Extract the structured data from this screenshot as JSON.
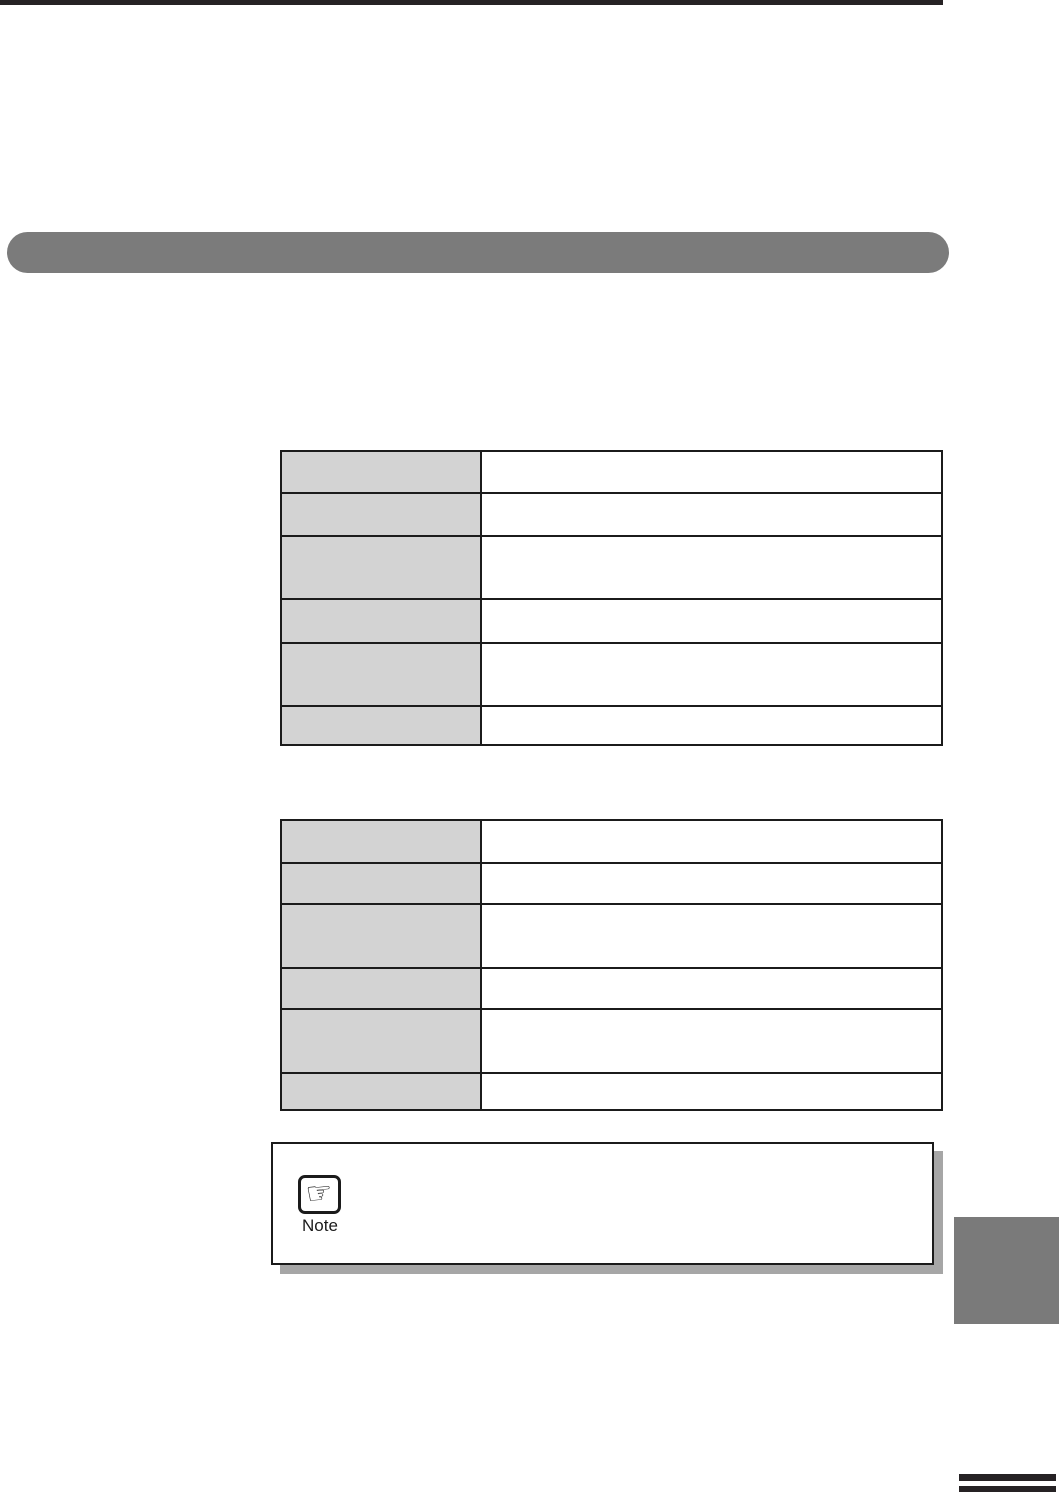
{
  "note_box": {
    "label": "Note",
    "icon": "pointing-hand-icon",
    "hand_glyph": "☞"
  },
  "tables": [
    {
      "name": "spec-table-1",
      "rows": [
        {
          "header": "",
          "value": ""
        },
        {
          "header": "",
          "value": ""
        },
        {
          "header": "",
          "value": ""
        },
        {
          "header": "",
          "value": ""
        },
        {
          "header": "",
          "value": ""
        },
        {
          "header": "",
          "value": ""
        }
      ]
    },
    {
      "name": "spec-table-2",
      "rows": [
        {
          "header": "",
          "value": ""
        },
        {
          "header": "",
          "value": ""
        },
        {
          "header": "",
          "value": ""
        },
        {
          "header": "",
          "value": ""
        },
        {
          "header": "",
          "value": ""
        },
        {
          "header": "",
          "value": ""
        }
      ]
    }
  ],
  "colors": {
    "top_rule": "#262224",
    "section_banner": "#7b7b7b",
    "table_header_cell": "#d3d3d3",
    "table_border": "#1b1b1b",
    "note_shadow": "#a6a6a6",
    "chapter_tab": "#7a7a7a",
    "footer_marks": "#262224"
  }
}
